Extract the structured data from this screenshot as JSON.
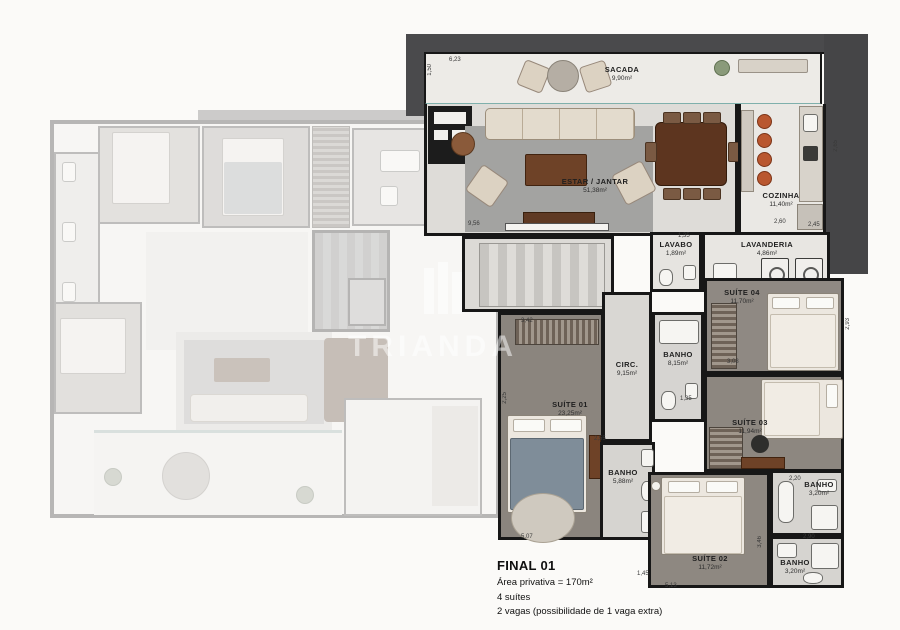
{
  "watermark": {
    "text": "TRIANDA"
  },
  "info": {
    "title": "FINAL 01",
    "area_line": "Área privativa = 170m²",
    "suites_line": "4 suítes",
    "parking_line": "2 vagas (possibilidade de 1 vaga extra)"
  },
  "rooms": {
    "sacada": {
      "name": "SACADA",
      "area": "9,90m²"
    },
    "estar_jantar": {
      "name": "ESTAR / JANTAR",
      "area": "51,38m²"
    },
    "cozinha": {
      "name": "COZINHA",
      "area": "11,40m²"
    },
    "lavabo": {
      "name": "LAVABO",
      "area": "1,89m²"
    },
    "lavanderia": {
      "name": "LAVANDERIA",
      "area": "4,86m²"
    },
    "circ": {
      "name": "CIRC.",
      "area": "9,15m²"
    },
    "suite01": {
      "name": "SUÍTE 01",
      "area": "23,25m²"
    },
    "suite02": {
      "name": "SUÍTE 02",
      "area": "11,72m²"
    },
    "suite03": {
      "name": "SUÍTE 03",
      "area": "11,94m²"
    },
    "suite04": {
      "name": "SUÍTE 04",
      "area": "11,70m²"
    },
    "banho_suite04": {
      "name": "BANHO",
      "area": "8,15m²"
    },
    "banho_suite01": {
      "name": "BANHO",
      "area": "5,88m²"
    },
    "banho_suite03": {
      "name": "BANHO",
      "area": "3,20m²"
    },
    "banho_suite02": {
      "name": "BANHO",
      "area": "3,20m²"
    }
  },
  "dims": [
    "6,23",
    "1,50",
    "9,56",
    "2,65",
    "2,60",
    "2,45",
    "1,35",
    "1,35",
    "3,08",
    "2,93",
    "2,25",
    "3,42",
    "5,07",
    "1,45",
    "5,13",
    "3,46",
    "2,20",
    "2,90",
    "2,55"
  ],
  "colors": {
    "wall": "#171717",
    "roof_band": "#4a4a4c",
    "glass": "#7fb0ac",
    "stool_accent": "#b9572f",
    "suite01_bed": "#7f8d99",
    "wood_floor": "#8d8781"
  }
}
